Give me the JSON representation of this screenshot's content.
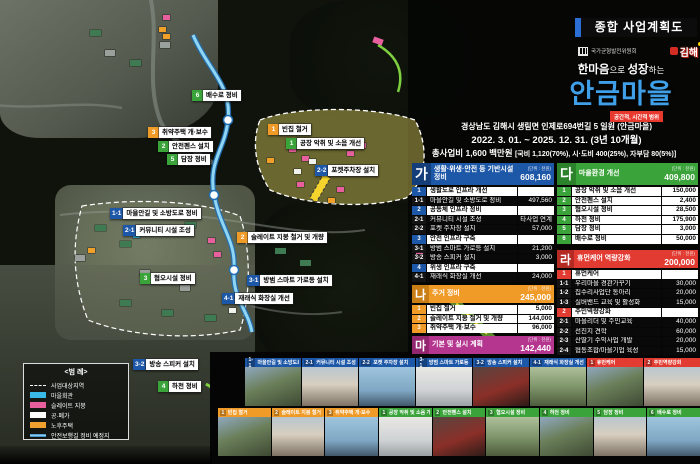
{
  "header": {
    "plan_title": "종합 사업계획도",
    "org_committee": "국가균형발전위원회",
    "org_city": "김해",
    "tagline_strong1": "한마음",
    "tagline_norm1": "으로 ",
    "tagline_strong2": "성장",
    "tagline_norm2": "하는",
    "village_name": "안금마을",
    "scope_label": "공간적, 시간적 범위",
    "address": "경상남도 김해시 생림면 인제로694번길 5 일원 (안금마을)",
    "period": "2022. 3. 01. ~ 2025. 12. 31. (3년 10개월)",
    "budget_main": "총사업비 1,600 백만원 ",
    "budget_detail": "[국비 1,120(70%), 시·도비 400(25%), 자부담 80(5%)]"
  },
  "colors": {
    "infra_blue": "#1d57a7",
    "housing_orange": "#f09a28",
    "plan_magenta": "#b5368f",
    "environment_green": "#3aa43a",
    "capacity_red": "#e23b32",
    "village_accent_blue": "#3f9fe8",
    "scope_red": "#e8392f"
  },
  "tables": {
    "ga": {
      "code": "가",
      "title": "생활·위생·안전 등 기반시설 정비",
      "unit": "(단위 : 천원)",
      "total": "608,160",
      "rows": [
        {
          "no": "1",
          "label": "생활도로 인프라 개선",
          "value": "",
          "head": true
        },
        {
          "no": "1-1",
          "label": "마을안길 및 소방도로 정비",
          "value": "497,560"
        },
        {
          "no": "2",
          "label": "공동체 인프라 정비",
          "value": "",
          "head": true
        },
        {
          "no": "2-1",
          "label": "커뮤니티 시설 조성",
          "value": "타사업 연계"
        },
        {
          "no": "2-2",
          "label": "포켓 주차장 설치",
          "value": "57,000"
        },
        {
          "no": "3",
          "label": "안전 인프라 구축",
          "value": "",
          "head": true
        },
        {
          "no": "3-1",
          "label": "방범 스마트 가로등 설치",
          "value": "21,200"
        },
        {
          "no": "3-2",
          "label": "방송 스피커 설치",
          "value": "3,000"
        },
        {
          "no": "4",
          "label": "위생 인프라 구축",
          "value": "",
          "head": true
        },
        {
          "no": "4-1",
          "label": "재래식 화장실 개선",
          "value": "24,000"
        }
      ]
    },
    "na": {
      "code": "나",
      "title": "주거 정비",
      "unit": "(단위 : 천원)",
      "total": "245,000",
      "rows": [
        {
          "no": "1",
          "label": "빈집 철거",
          "value": "5,000",
          "head": true
        },
        {
          "no": "2",
          "label": "슬레이트 지붕 철거 및 개량",
          "value": "144,000",
          "head": true
        },
        {
          "no": "3",
          "label": "취약주택 개·보수",
          "value": "96,000",
          "head": true
        }
      ]
    },
    "ma": {
      "code": "마",
      "title": "기본 및 실시 계획",
      "unit": "(단위 : 천원)",
      "total": "142,440"
    },
    "da": {
      "code": "다",
      "title": "마을환경 개선",
      "unit": "(단위 : 천원)",
      "total": "409,800",
      "rows": [
        {
          "no": "1",
          "label": "공장 악취 및 소음 개선",
          "value": "150,000",
          "head": true
        },
        {
          "no": "2",
          "label": "안전펜스 설치",
          "value": "2,400",
          "head": true
        },
        {
          "no": "3",
          "label": "혐오시설 정비",
          "value": "28,500",
          "head": true
        },
        {
          "no": "4",
          "label": "하천 정비",
          "value": "175,900",
          "head": true
        },
        {
          "no": "5",
          "label": "담장 정비",
          "value": "3,000",
          "head": true
        },
        {
          "no": "6",
          "label": "배수로 정비",
          "value": "50,000",
          "head": true
        }
      ]
    },
    "ra": {
      "code": "라",
      "title": "휴먼케어 역량강화",
      "unit": "(단위 : 천원)",
      "total": "200,000",
      "rows": [
        {
          "no": "1",
          "label": "휴먼케어",
          "value": "",
          "head": true
        },
        {
          "no": "1-1",
          "label": "우리마을 경관가꾸기",
          "value": "30,000"
        },
        {
          "no": "1-2",
          "label": "집수리사업단 동아리",
          "value": "20,000"
        },
        {
          "no": "1-3",
          "label": "실버밴드 교육 및 활성화",
          "value": "15,000"
        },
        {
          "no": "2",
          "label": "주민역량강화",
          "value": "",
          "head": true
        },
        {
          "no": "2-1",
          "label": "마을리더 및 주민교육",
          "value": "40,000"
        },
        {
          "no": "2-2",
          "label": "선진지 견학",
          "value": "60,000"
        },
        {
          "no": "2-3",
          "label": "산딸기 수익사업 개발",
          "value": "20,000"
        },
        {
          "no": "2-4",
          "label": "협동조합/마을기업 육성",
          "value": "15,000"
        }
      ]
    }
  },
  "map_labels": [
    {
      "no": "6",
      "text": "배수로 정비",
      "kind": "green",
      "x": 192,
      "y": 90
    },
    {
      "no": "1",
      "text": "빈집 철거",
      "kind": "orange",
      "x": 268,
      "y": 124
    },
    {
      "no": "3",
      "text": "취약주택 개·보수",
      "kind": "orange",
      "x": 148,
      "y": 127
    },
    {
      "no": "1",
      "text": "공장 악취 및 소음 개선",
      "kind": "green",
      "x": 286,
      "y": 138
    },
    {
      "no": "2",
      "text": "안전펜스 설치",
      "kind": "green",
      "x": 158,
      "y": 141
    },
    {
      "no": "5",
      "text": "담장 정비",
      "kind": "green",
      "x": 167,
      "y": 154
    },
    {
      "no": "2-2",
      "text": "포켓주차장 설치",
      "kind": "blue",
      "x": 315,
      "y": 165
    },
    {
      "no": "1-1",
      "text": "마을안길 및 소방도로 정비",
      "kind": "blue",
      "x": 110,
      "y": 208
    },
    {
      "no": "2-1",
      "text": "커뮤니티 시설 조성",
      "kind": "blue",
      "x": 123,
      "y": 225
    },
    {
      "no": "2",
      "text": "슬레이트 지붕 철거 및 개량",
      "kind": "orange",
      "x": 237,
      "y": 232
    },
    {
      "no": "3",
      "text": "혐오시설 정비",
      "kind": "green",
      "x": 140,
      "y": 273
    },
    {
      "no": "3-1",
      "text": "방범 스마트 가로등 설치",
      "kind": "blue",
      "x": 247,
      "y": 275
    },
    {
      "no": "4-1",
      "text": "재래식 화장실 개선",
      "kind": "blue",
      "x": 222,
      "y": 293
    },
    {
      "no": "3-2",
      "text": "방송 스피커 설치",
      "kind": "blue",
      "x": 133,
      "y": 359
    },
    {
      "no": "4",
      "text": "하천 정비",
      "kind": "green",
      "x": 158,
      "y": 381
    }
  ],
  "map_markers": [
    {
      "kind": "pink",
      "x": 163,
      "y": 15
    },
    {
      "kind": "pink",
      "x": 289,
      "y": 147
    },
    {
      "kind": "pink",
      "x": 302,
      "y": 156
    },
    {
      "kind": "pink",
      "x": 347,
      "y": 151
    },
    {
      "kind": "pink",
      "x": 359,
      "y": 143
    },
    {
      "kind": "pink",
      "x": 297,
      "y": 182
    },
    {
      "kind": "pink",
      "x": 337,
      "y": 187
    },
    {
      "kind": "pink",
      "x": 413,
      "y": 237
    },
    {
      "kind": "pink",
      "x": 416,
      "y": 252
    },
    {
      "kind": "pink",
      "x": 419,
      "y": 266
    },
    {
      "kind": "pink",
      "x": 208,
      "y": 238
    },
    {
      "kind": "pink",
      "x": 214,
      "y": 252
    },
    {
      "kind": "orange",
      "x": 159,
      "y": 27
    },
    {
      "kind": "orange",
      "x": 163,
      "y": 34
    },
    {
      "kind": "orange",
      "x": 267,
      "y": 158
    },
    {
      "kind": "orange",
      "x": 328,
      "y": 198
    },
    {
      "kind": "orange",
      "x": 88,
      "y": 248
    },
    {
      "kind": "white",
      "x": 309,
      "y": 159
    },
    {
      "kind": "white",
      "x": 294,
      "y": 169
    },
    {
      "kind": "white",
      "x": 229,
      "y": 308
    },
    {
      "kind": "cyan",
      "x": 133,
      "y": 233
    },
    {
      "kind": "green",
      "x": 95,
      "y": 225
    },
    {
      "kind": "green",
      "x": 120,
      "y": 241
    },
    {
      "kind": "green",
      "x": 150,
      "y": 228
    },
    {
      "kind": "green",
      "x": 185,
      "y": 222
    },
    {
      "kind": "green",
      "x": 275,
      "y": 248
    },
    {
      "kind": "green",
      "x": 300,
      "y": 260
    },
    {
      "kind": "green",
      "x": 120,
      "y": 300
    },
    {
      "kind": "green",
      "x": 162,
      "y": 310
    },
    {
      "kind": "green",
      "x": 205,
      "y": 315
    },
    {
      "kind": "green",
      "x": 90,
      "y": 30
    },
    {
      "kind": "green",
      "x": 130,
      "y": 60
    },
    {
      "kind": "gray",
      "x": 75,
      "y": 255
    },
    {
      "kind": "gray",
      "x": 140,
      "y": 270
    },
    {
      "kind": "gray",
      "x": 180,
      "y": 285
    },
    {
      "kind": "gray",
      "x": 105,
      "y": 50
    },
    {
      "kind": "gray",
      "x": 160,
      "y": 42
    }
  ],
  "legend": {
    "title": "<범 례>",
    "items": [
      {
        "kind": "dashed",
        "label": "사업대상지역"
      },
      {
        "kind": "cyan",
        "label": "마을회관"
      },
      {
        "kind": "pink",
        "label": "슬레이트 지붕"
      },
      {
        "kind": "white",
        "label": "공·폐가"
      },
      {
        "kind": "orange",
        "label": "노후주택"
      },
      {
        "kind": "blueline",
        "label": "안전보행길 정비 예정지"
      }
    ]
  },
  "photos_top": [
    {
      "no": "1-1",
      "label": "마을안길 및 소방도로 정비",
      "kind": "blue"
    },
    {
      "no": "2-1",
      "label": "커뮤니티 시설 조성",
      "kind": "blue"
    },
    {
      "no": "2-2",
      "label": "포켓 주차장 설치",
      "kind": "blue"
    },
    {
      "no": "3-1",
      "label": "방범 스마트 가로등 설치",
      "kind": "blue"
    },
    {
      "no": "3-2",
      "label": "방송 스피커 설치",
      "kind": "blue"
    },
    {
      "no": "4-1",
      "label": "재래식 화장실 개선",
      "kind": "blue"
    },
    {
      "no": "1",
      "label": "휴먼케어",
      "kind": "red"
    },
    {
      "no": "2",
      "label": "주민역량강화",
      "kind": "red"
    }
  ],
  "photos_bottom": [
    {
      "no": "1",
      "label": "빈집 철거",
      "kind": "orange"
    },
    {
      "no": "2",
      "label": "슬레이트 지붕 철거 및 개량",
      "kind": "orange"
    },
    {
      "no": "3",
      "label": "취약주택 개·보수",
      "kind": "orange"
    },
    {
      "no": "1",
      "label": "공장 악취 및 소음 개선",
      "kind": "green"
    },
    {
      "no": "2",
      "label": "안전펜스 설치",
      "kind": "green"
    },
    {
      "no": "3",
      "label": "혐오시설 정비",
      "kind": "green"
    },
    {
      "no": "4",
      "label": "하천 정비",
      "kind": "green"
    },
    {
      "no": "5",
      "label": "담장 정비",
      "kind": "green"
    },
    {
      "no": "6",
      "label": "배수로 정비",
      "kind": "green"
    }
  ]
}
